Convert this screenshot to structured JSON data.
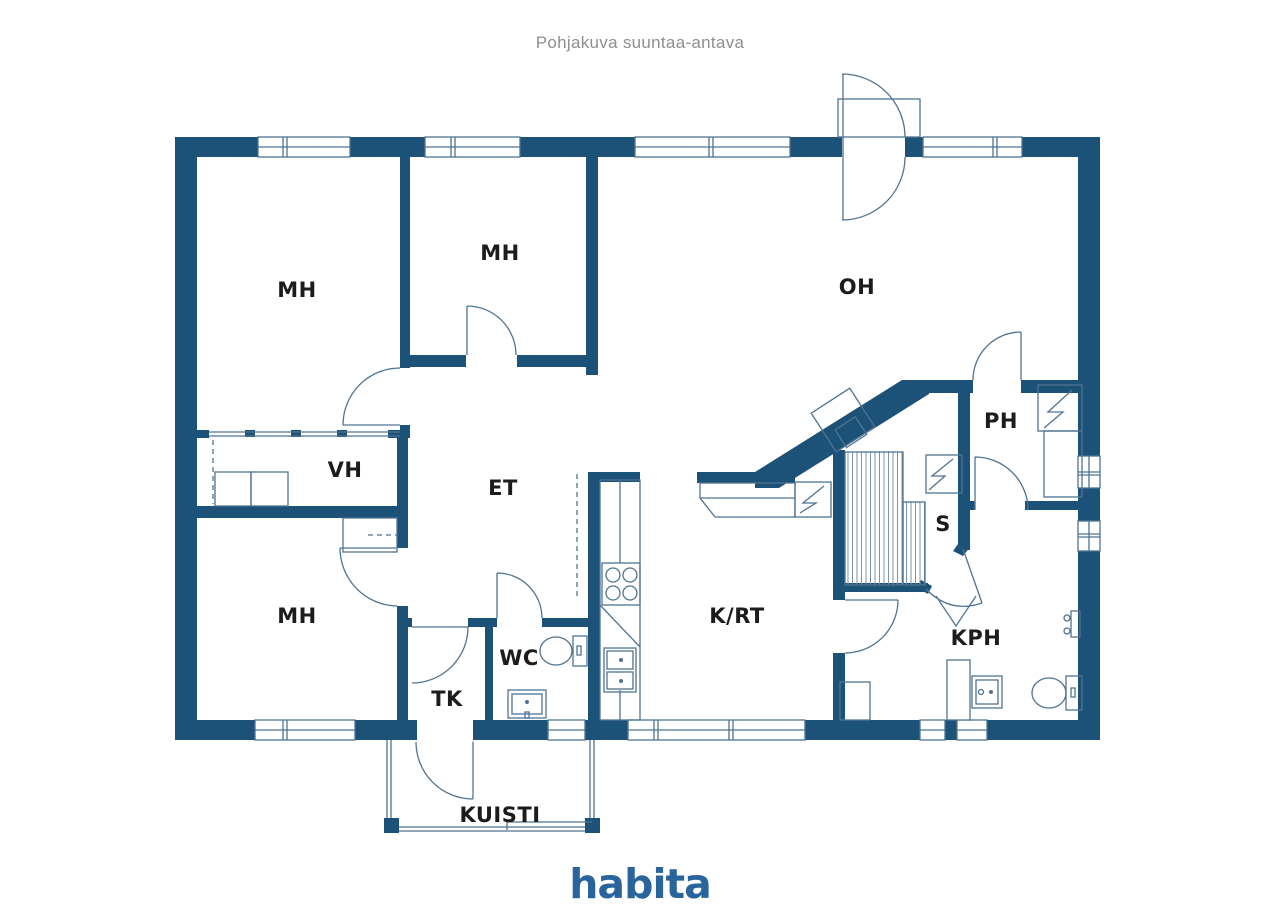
{
  "title": "Pohjakuva suuntaa-antava",
  "brand": {
    "logo_text": "habita"
  },
  "colors": {
    "wall": "#1d5278",
    "line": "#4f7392",
    "label": "#1c1c1c",
    "title": "#8f8f8f",
    "brand": "#2a649c",
    "background": "#ffffff"
  },
  "floorplan": {
    "rooms": [
      {
        "id": "mh-top-left",
        "label": "MH",
        "x": 297,
        "y": 290
      },
      {
        "id": "mh-top-middle",
        "label": "MH",
        "x": 500,
        "y": 253
      },
      {
        "id": "oh",
        "label": "OH",
        "x": 857,
        "y": 287
      },
      {
        "id": "vh",
        "label": "VH",
        "x": 345,
        "y": 470
      },
      {
        "id": "et",
        "label": "ET",
        "x": 503,
        "y": 488
      },
      {
        "id": "ph",
        "label": "PH",
        "x": 1001,
        "y": 421
      },
      {
        "id": "sauna",
        "label": "S",
        "x": 943,
        "y": 524
      },
      {
        "id": "mh-bottom-left",
        "label": "MH",
        "x": 297,
        "y": 616
      },
      {
        "id": "krt",
        "label": "K/RT",
        "x": 737,
        "y": 616
      },
      {
        "id": "kph",
        "label": "KPH",
        "x": 976,
        "y": 638
      },
      {
        "id": "wc",
        "label": "WC",
        "x": 519,
        "y": 658
      },
      {
        "id": "tk",
        "label": "TK",
        "x": 447,
        "y": 699
      },
      {
        "id": "kuisti",
        "label": "KUISTI",
        "x": 500,
        "y": 815
      }
    ]
  }
}
